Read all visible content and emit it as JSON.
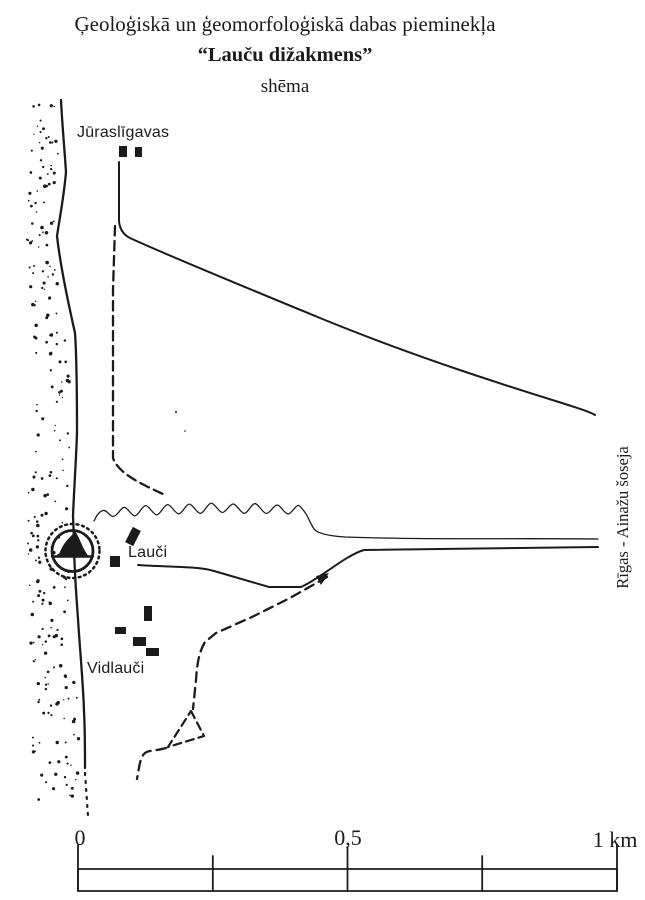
{
  "title": {
    "line1": "Ģeoloģiskā un ģeomorfoloģiskā dabas pieminekļa",
    "line2": "“Lauču dižakmens”",
    "line3": "shēma"
  },
  "map": {
    "place_labels": {
      "north_settlement": "Jūraslīgavas",
      "central_settlement": "Lauči",
      "south_settlement": "Vidlauči"
    },
    "highway_label": "Rīgas - Ainažu šoseja",
    "monument_symbol": "boulder-in-double-circle",
    "features": {
      "coastline": "shoreline with stippled beach",
      "solid_lines": "roads",
      "dashed_lines": "footpaths / tracks",
      "thin_wavy_line": "stream"
    }
  },
  "scale_bar": {
    "tick_labels": [
      "0",
      "0,5",
      "1 km"
    ],
    "units": "km"
  },
  "colors": {
    "ink": "#1b1b1b",
    "paper": "#ffffff"
  }
}
